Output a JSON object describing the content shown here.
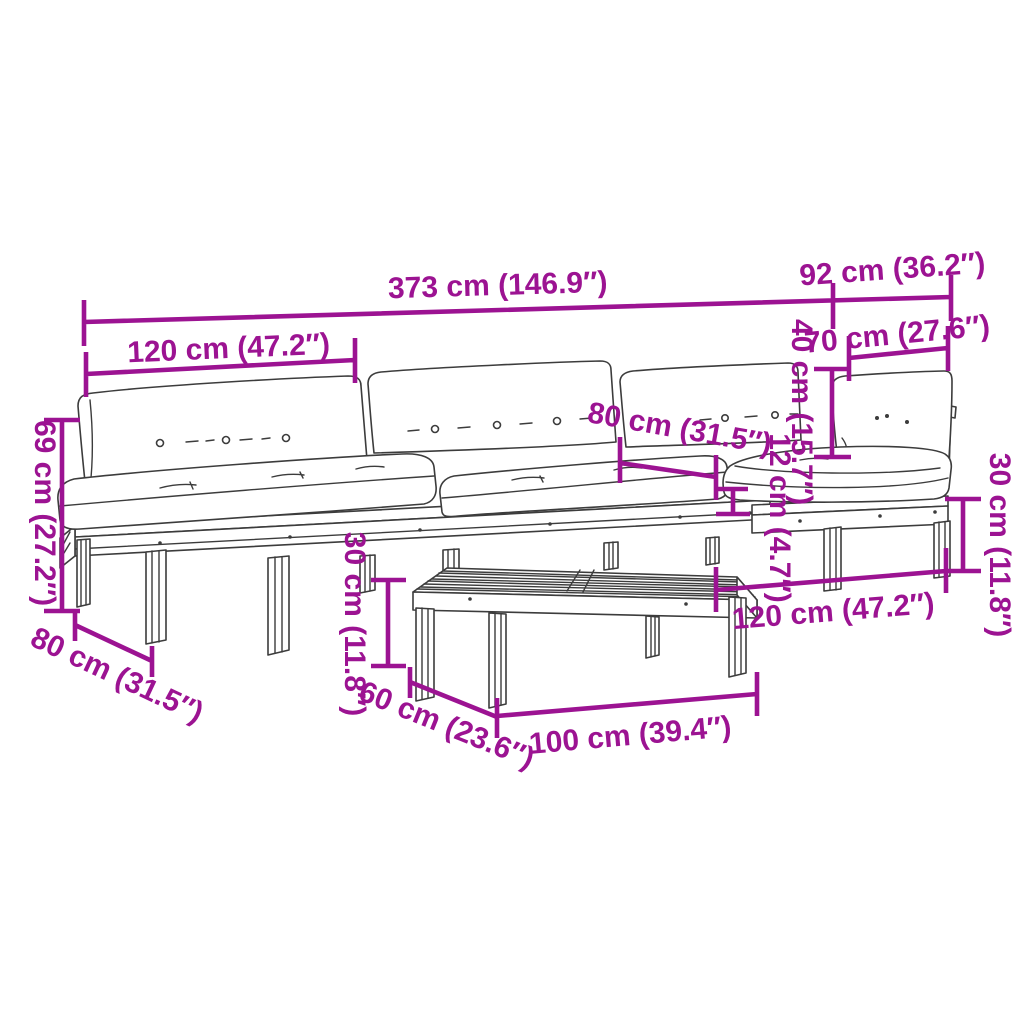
{
  "colors": {
    "dimension_accent": "#9C1392",
    "line_art": "#3C3C3C",
    "background": "#FFFFFF"
  },
  "diagram": {
    "kind": "product-dimension-diagram",
    "subject": "4-piece pallet garden lounge set with cushions and coffee table"
  },
  "dims": {
    "total_length": "373 cm (146.9″)",
    "corner_depth_total": "92 cm (36.2″)",
    "module_length": "120 cm (47.2″)",
    "corner_seat_width": "70 cm (27.6″)",
    "backrest_cushion_height": "40 cm (15.7″)",
    "seat_depth": "80 cm (31.5″)",
    "seat_cushion_thickness": "12 cm (4.7″)",
    "total_height": "69 cm (27.2″)",
    "module_depth": "80 cm (31.5″)",
    "table_height": "30 cm (11.8″)",
    "table_depth": "60 cm (23.6″)",
    "table_length": "100 cm (39.4″)",
    "corner_module_length": "120 cm (47.2″)",
    "base_height": "30 cm (11.8″)"
  }
}
